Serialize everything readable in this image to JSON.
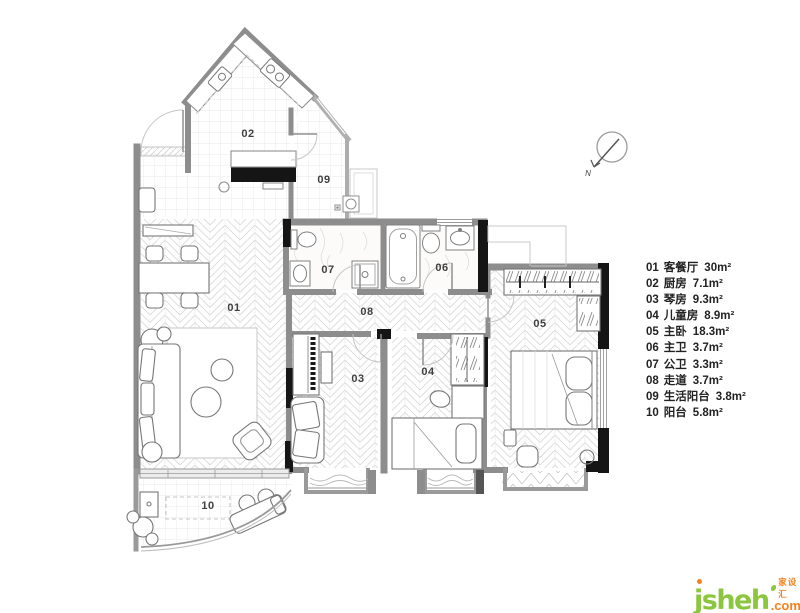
{
  "page": {
    "background": "#ffffff"
  },
  "plan": {
    "room_labels": [
      {
        "id": "01",
        "text": "01"
      },
      {
        "id": "02",
        "text": "02"
      },
      {
        "id": "03",
        "text": "03"
      },
      {
        "id": "04",
        "text": "04"
      },
      {
        "id": "05",
        "text": "05"
      },
      {
        "id": "06",
        "text": "06"
      },
      {
        "id": "07",
        "text": "07"
      },
      {
        "id": "08",
        "text": "08"
      },
      {
        "id": "09",
        "text": "09"
      },
      {
        "id": "10",
        "text": "10"
      }
    ],
    "compass": {
      "label": "N"
    }
  },
  "legend": {
    "items": [
      {
        "number": "01",
        "name": "客餐厅",
        "area": "30m²"
      },
      {
        "number": "02",
        "name": "厨房",
        "area": "7.1m²"
      },
      {
        "number": "03",
        "name": "琴房",
        "area": "9.3m²"
      },
      {
        "number": "04",
        "name": "儿童房",
        "area": "8.9m²"
      },
      {
        "number": "05",
        "name": "主卧",
        "area": "18.3m²"
      },
      {
        "number": "06",
        "name": "主卫",
        "area": "3.7m²"
      },
      {
        "number": "07",
        "name": "公卫",
        "area": "3.3m²"
      },
      {
        "number": "08",
        "name": "走道",
        "area": "3.7m²"
      },
      {
        "number": "09",
        "name": "生活阳台",
        "area": "3.8m²"
      },
      {
        "number": "10",
        "name": "阳台",
        "area": "5.8m²"
      }
    ]
  },
  "watermark": {
    "brand": "jsheh",
    "cjk": "家设汇",
    "tld": ".com"
  },
  "colors": {
    "wall": "#8d8d8d",
    "wall_black": "#151515",
    "floor_line": "#d6d6d6",
    "legend_text": "#222222",
    "brand_green": "#8cc63f",
    "brand_orange": "#f58220"
  }
}
